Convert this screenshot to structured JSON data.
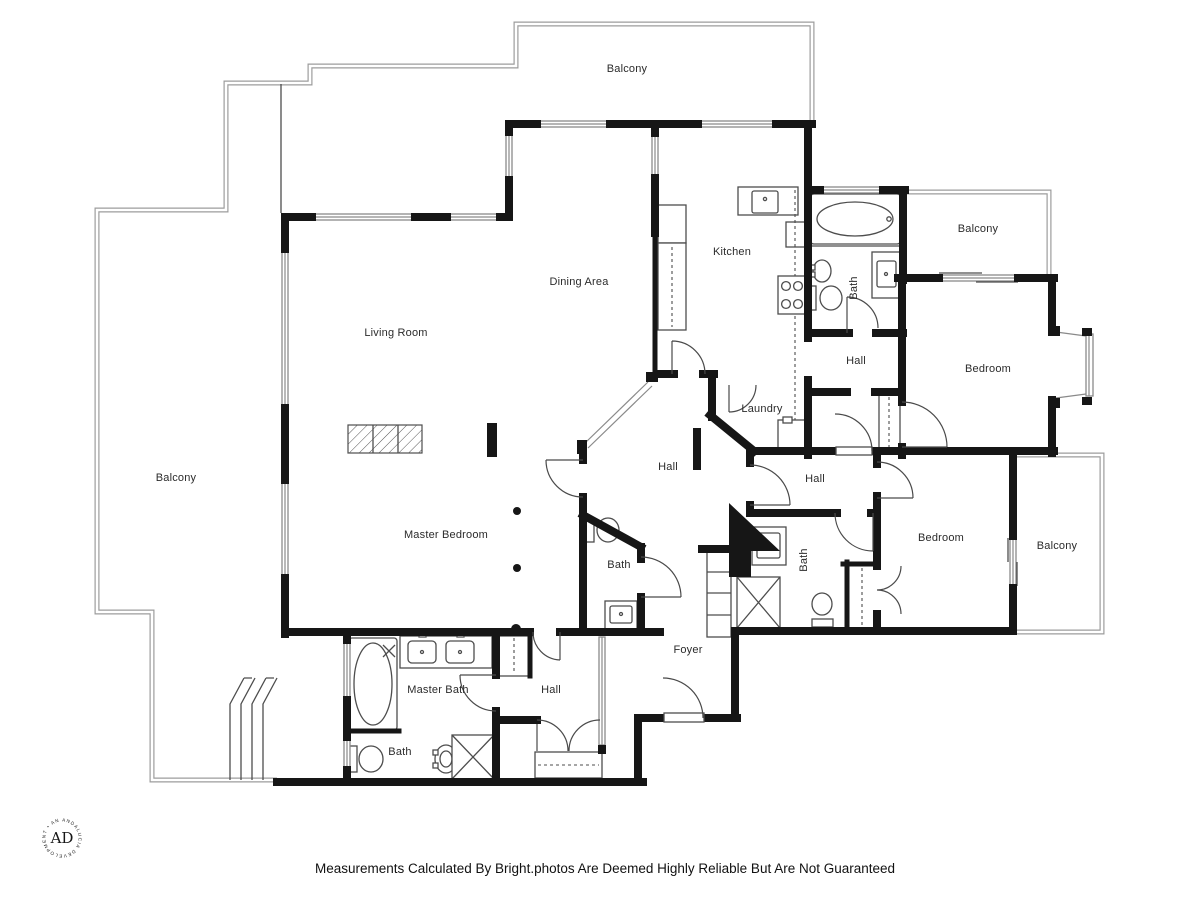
{
  "colors": {
    "wall": "#161616",
    "line": "#4d4d4d",
    "window": "#8a8a8a",
    "balcony_outline": "#9c9c9c",
    "label": "#2b2b2b",
    "background": "#ffffff"
  },
  "plan": {
    "footer": "Measurements Calculated By Bright.photos Are Deemed Highly Reliable But Are Not Guaranteed",
    "logo": {
      "monogram": "AD",
      "ring_text": "ANDALUCIA DEVELOPMENT • ANDALUCIA •"
    },
    "rooms": [
      {
        "id": "balcony-top",
        "label": "Balcony",
        "x": 627,
        "y": 72,
        "rot": 0
      },
      {
        "id": "living-room",
        "label": "Living Room",
        "x": 396,
        "y": 336,
        "rot": 0
      },
      {
        "id": "dining-area",
        "label": "Dining Area",
        "x": 579,
        "y": 285,
        "rot": 0
      },
      {
        "id": "kitchen",
        "label": "Kitchen",
        "x": 732,
        "y": 255,
        "rot": 0
      },
      {
        "id": "bath-top-right",
        "label": "Bath",
        "x": 857,
        "y": 288,
        "rot": -90
      },
      {
        "id": "balcony-top-right",
        "label": "Balcony",
        "x": 978,
        "y": 232,
        "rot": 0
      },
      {
        "id": "hall-top-right",
        "label": "Hall",
        "x": 856,
        "y": 364,
        "rot": 0
      },
      {
        "id": "bedroom-top-right",
        "label": "Bedroom",
        "x": 988,
        "y": 372,
        "rot": 0
      },
      {
        "id": "laundry",
        "label": "Laundry",
        "x": 762,
        "y": 412,
        "rot": 0
      },
      {
        "id": "hall-center",
        "label": "Hall",
        "x": 668,
        "y": 470,
        "rot": 0
      },
      {
        "id": "hall-right",
        "label": "Hall",
        "x": 815,
        "y": 482,
        "rot": 0
      },
      {
        "id": "balcony-left",
        "label": "Balcony",
        "x": 176,
        "y": 481,
        "rot": 0
      },
      {
        "id": "master-bedroom",
        "label": "Master Bedroom",
        "x": 446,
        "y": 538,
        "rot": 0
      },
      {
        "id": "bath-center",
        "label": "Bath",
        "x": 619,
        "y": 568,
        "rot": 0
      },
      {
        "id": "bath-bottom-right",
        "label": "Bath",
        "x": 807,
        "y": 560,
        "rot": -90
      },
      {
        "id": "bedroom-bottom-right",
        "label": "Bedroom",
        "x": 941,
        "y": 541,
        "rot": 0
      },
      {
        "id": "balcony-bottom-right",
        "label": "Balcony",
        "x": 1057,
        "y": 549,
        "rot": 0
      },
      {
        "id": "foyer",
        "label": "Foyer",
        "x": 688,
        "y": 653,
        "rot": 0
      },
      {
        "id": "master-bath",
        "label": "Master Bath",
        "x": 438,
        "y": 693,
        "rot": 0
      },
      {
        "id": "hall-bottom",
        "label": "Hall",
        "x": 551,
        "y": 693,
        "rot": 0
      },
      {
        "id": "bath-bottom-left",
        "label": "Bath",
        "x": 400,
        "y": 755,
        "rot": 0
      }
    ]
  }
}
